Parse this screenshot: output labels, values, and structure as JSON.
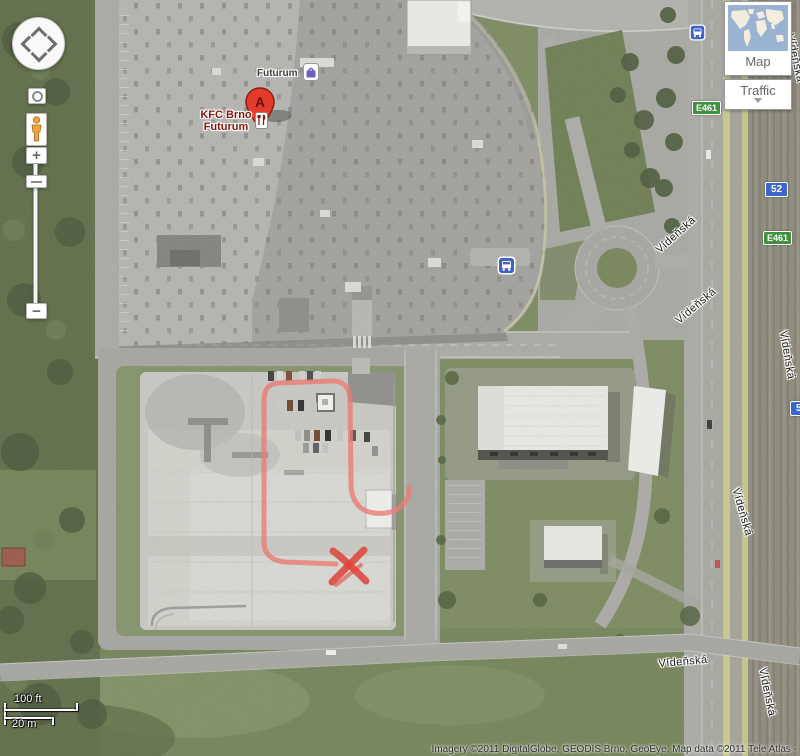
{
  "map_ui": {
    "nav": {
      "zoom_in": "+",
      "zoom_out": "−"
    },
    "map_type_control": {
      "map_label": "Map",
      "traffic_label": "Traffic"
    },
    "scale_bar": {
      "imperial": "100 ft",
      "metric": "20 m"
    },
    "attribution": "Imagery ©2011 DigitalGlobe, GEODIS Brno, GeoEye, Map data ©2011 Tele Atlas -"
  },
  "map_content": {
    "marker_letter": "A",
    "kfc_label": {
      "line1": "KFC Brno",
      "line2": "Futurum"
    },
    "mall_label": "Futurum",
    "street_name": "Vídeňská",
    "routes": {
      "e_route": "E461",
      "national_route": "52"
    }
  },
  "colors": {
    "marker_red": "#e23b2c",
    "annotation_red": "#ee7870",
    "x_mark_red": "#e03b30",
    "e_route_green": "#3f9140",
    "route_blue": "#3a67c8",
    "overview_ocean": "#9ab3d3",
    "overview_land": "#f2eddc"
  }
}
